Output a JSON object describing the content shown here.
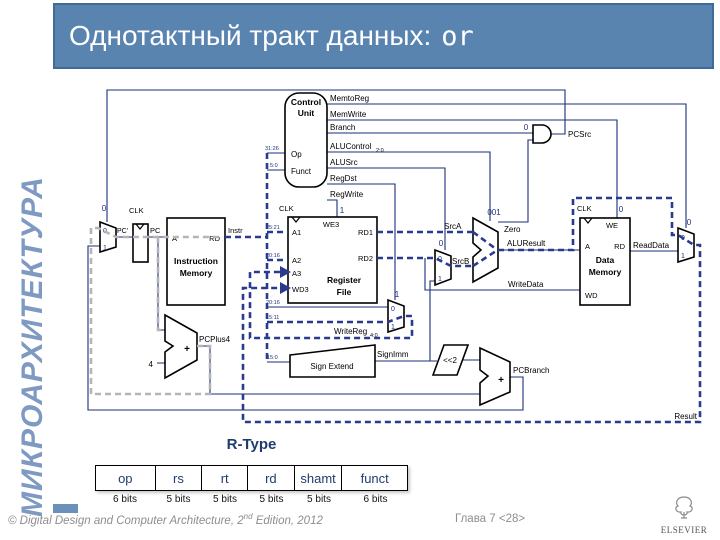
{
  "sidebar": {
    "vertical_text": "МИКРОАРХИТЕКТУРА"
  },
  "title_bar": {
    "text": "Однотактный тракт данных:",
    "instruction": "or",
    "bg_color": "#5a84b0"
  },
  "diagram": {
    "clk": "CLK",
    "components": {
      "instruction_memory": [
        "Instruction",
        "Memory"
      ],
      "control_unit": [
        "Control",
        "Unit"
      ],
      "register_file": [
        "Register",
        "File"
      ],
      "data_memory": [
        "Data",
        "Memory"
      ],
      "sign_extend": "Sign Extend",
      "shift_left": "<<2",
      "plus": "+",
      "four": "4"
    },
    "ports": {
      "a": "A",
      "rd": "RD",
      "wd": "WD",
      "we": "WE",
      "we3": "WE3",
      "a1": "A1",
      "a2": "A2",
      "a3": "A3",
      "wd3": "WD3",
      "rd1": "RD1",
      "rd2": "RD2",
      "op": "Op",
      "funct": "Funct"
    },
    "wires": {
      "pc_prime": "PC'",
      "pc": "PC",
      "instr": "Instr",
      "src_a": "SrcA",
      "src_b": "SrcB",
      "alu_result": "ALUResult",
      "write_data": "WriteData",
      "read_data": "ReadData",
      "write_reg": "WriteReg",
      "write_reg_sub": "4:0",
      "sign_imm": "SignImm",
      "pc_plus4": "PCPlus4",
      "pc_branch": "PCBranch",
      "pc_src": "PCSrc",
      "zero": "Zero",
      "result": "Result"
    },
    "control": {
      "memtoreg": "MemtoReg",
      "memwrite": "MemWrite",
      "branch": "Branch",
      "alucontrol": "ALUControl",
      "alucontrol_sub": "2:0",
      "alusrc": "ALUSrc",
      "regdst": "RegDst",
      "regwrite": "RegWrite"
    },
    "values": {
      "pcsrc": "0",
      "branch": "0",
      "regwrite": "1",
      "memwrite": "0",
      "alucontrol": "001",
      "alusrc": "0",
      "regdst": "1",
      "memtoreg": "0",
      "mux0": "0",
      "mux1": "1"
    },
    "bit_ranges": {
      "op": "31:26",
      "funct": "5:0",
      "a1": "25:21",
      "a2": "20:16",
      "rd0": "20:16",
      "rd1": "15:11",
      "imm": "15:0"
    },
    "highlight_colors": {
      "data_path": "#2a3a8e",
      "pc_path": "#b5b5b5"
    }
  },
  "rtype": {
    "title": "R-Type",
    "fields": [
      {
        "name": "op",
        "bits": "6 bits"
      },
      {
        "name": "rs",
        "bits": "5 bits"
      },
      {
        "name": "rt",
        "bits": "5 bits"
      },
      {
        "name": "rd",
        "bits": "5 bits"
      },
      {
        "name": "shamt",
        "bits": "5 bits"
      },
      {
        "name": "funct",
        "bits": "6 bits"
      }
    ]
  },
  "footer": {
    "copyright_prefix": "© ",
    "book_title": "Digital Design and Computer Architecture",
    "edition_pre": ", 2",
    "edition_sup": "nd",
    "edition_post": " Edition, 2012",
    "chapter": "Глава 7 <28>",
    "publisher": "ELSEVIER"
  }
}
